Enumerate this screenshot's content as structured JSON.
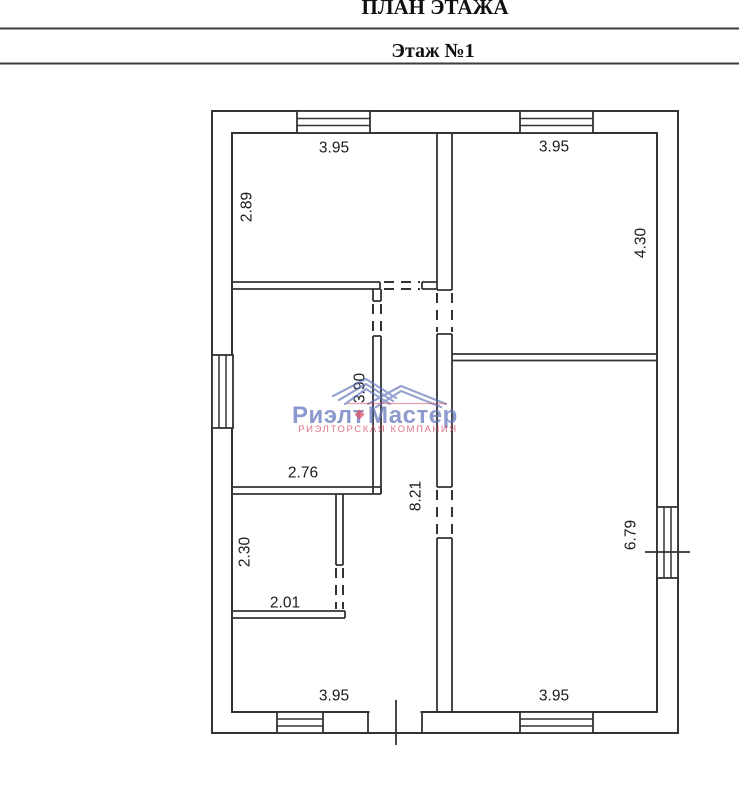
{
  "page": {
    "title": "ПЛАН ЭТАЖА",
    "subtitle": "Этаж №1"
  },
  "watermark": {
    "word1": "Риэлт",
    "word2": "Мастер",
    "tagline": "РИЭЛТОРСКАЯ КОМПАНИЯ",
    "brand_blue": "#5f73b9",
    "brand_red": "#d9536a"
  },
  "plan": {
    "line_color": "#333333",
    "dimensions": [
      {
        "id": "top-left-width",
        "text": "3.95",
        "x": 334,
        "y": 147,
        "rotated": false
      },
      {
        "id": "top-left-height",
        "text": "2.89",
        "x": 246,
        "y": 207,
        "rotated": true
      },
      {
        "id": "top-right-width",
        "text": "3.95",
        "x": 554,
        "y": 146,
        "rotated": false
      },
      {
        "id": "top-right-height",
        "text": "4.30",
        "x": 640,
        "y": 243,
        "rotated": true
      },
      {
        "id": "mid-left-height",
        "text": "3.90",
        "x": 359,
        "y": 388,
        "rotated": true
      },
      {
        "id": "mid-left-width",
        "text": "2.76",
        "x": 303,
        "y": 472,
        "rotated": false
      },
      {
        "id": "corridor-height",
        "text": "8.21",
        "x": 415,
        "y": 496,
        "rotated": true
      },
      {
        "id": "lower-left-height",
        "text": "2.30",
        "x": 244,
        "y": 552,
        "rotated": true
      },
      {
        "id": "lower-left-width",
        "text": "2.01",
        "x": 285,
        "y": 602,
        "rotated": false
      },
      {
        "id": "bottom-right-height",
        "text": "6.79",
        "x": 630,
        "y": 535,
        "rotated": true
      },
      {
        "id": "bottom-left-width",
        "text": "3.95",
        "x": 334,
        "y": 695,
        "rotated": false
      },
      {
        "id": "bottom-right-width",
        "text": "3.95",
        "x": 554,
        "y": 695,
        "rotated": false
      }
    ]
  }
}
